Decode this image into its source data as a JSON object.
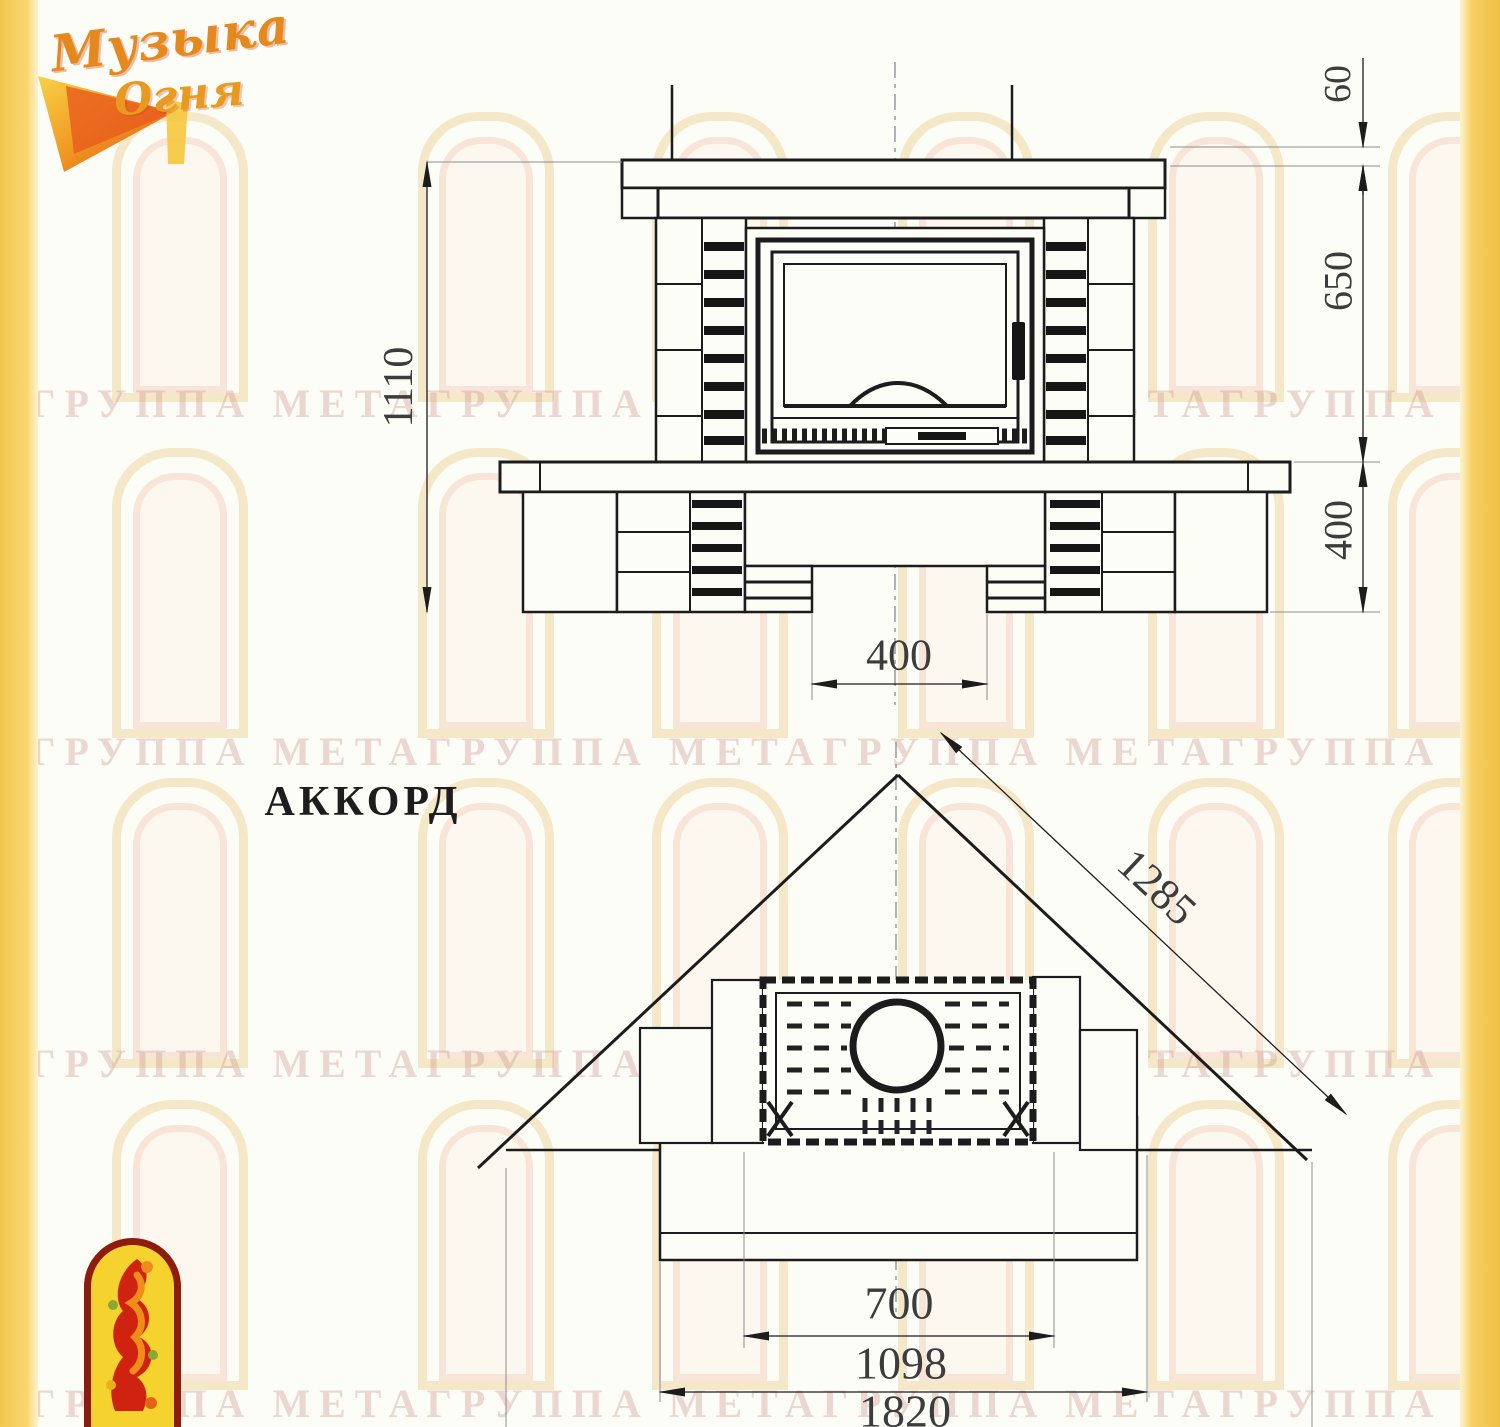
{
  "page": {
    "bg": "#fdfdf8",
    "strip_color": "#f3c74e",
    "line_color": "#1c1c1c"
  },
  "logo": {
    "word1": "Музыка",
    "word2": "Огня"
  },
  "watermark": {
    "text": "ГРУППА МЕТАГРУППА МЕТАГРУППА МЕТАГРУППА МЕТА"
  },
  "model_label": "АККОРД",
  "front_view": {
    "height_overall": "1110",
    "mantel_thickness": "60",
    "opening_height": "650",
    "base_height": "400",
    "bottom_gap_width": "400"
  },
  "plan_view": {
    "diagonal_width": "1285",
    "opening_width": "700",
    "body_width": "1098",
    "overall_width": "1820"
  }
}
